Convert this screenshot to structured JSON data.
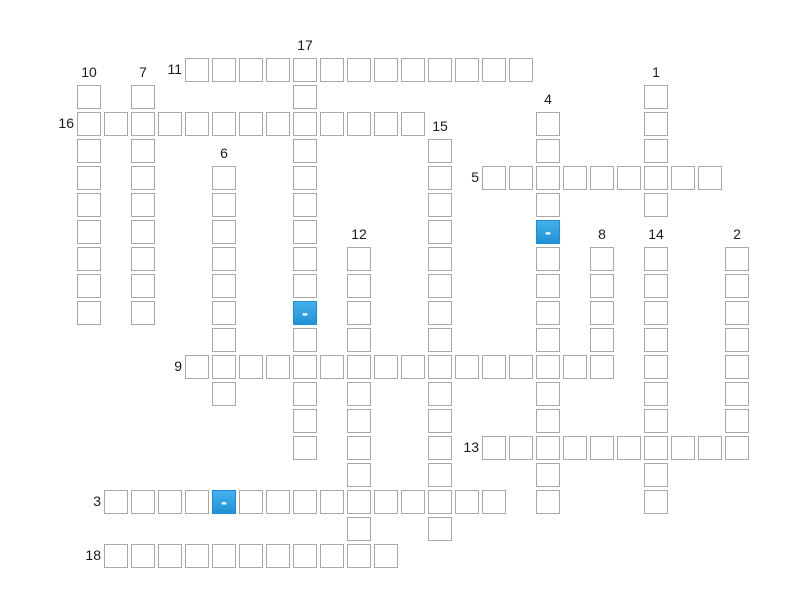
{
  "puzzle": {
    "type": "crossword-grid",
    "background_color": "#ffffff",
    "cell": {
      "size": 24,
      "pitch": 27,
      "origin_x": 77,
      "origin_y": 58,
      "fill": "#ffffff",
      "border_color": "#a8a8a8"
    },
    "highlight": {
      "fill_top": "#45b0ea",
      "fill_bottom": "#1f93d7",
      "border_color": "#1a8fd1",
      "dash_color": "#ffffff"
    },
    "label_color": "#1a1a1a",
    "words": [
      {
        "number": "17",
        "direction": "down",
        "col": 8,
        "row": 0,
        "length": 15
      },
      {
        "number": "11",
        "direction": "across",
        "col": 4,
        "row": 0,
        "length": 13
      },
      {
        "number": "10",
        "direction": "down",
        "col": 0,
        "row": 1,
        "length": 9
      },
      {
        "number": "7",
        "direction": "down",
        "col": 2,
        "row": 1,
        "length": 9
      },
      {
        "number": "1",
        "direction": "down",
        "col": 21,
        "row": 1,
        "length": 5
      },
      {
        "number": "16",
        "direction": "across",
        "col": 0,
        "row": 2,
        "length": 13
      },
      {
        "number": "4",
        "direction": "down",
        "col": 17,
        "row": 2,
        "length": 15
      },
      {
        "number": "15",
        "direction": "down",
        "col": 13,
        "row": 3,
        "length": 15
      },
      {
        "number": "6",
        "direction": "down",
        "col": 5,
        "row": 4,
        "length": 9
      },
      {
        "number": "5",
        "direction": "across",
        "col": 15,
        "row": 4,
        "length": 9
      },
      {
        "number": "12",
        "direction": "down",
        "col": 10,
        "row": 7,
        "length": 12
      },
      {
        "number": "8",
        "direction": "down",
        "col": 19,
        "row": 7,
        "length": 5
      },
      {
        "number": "14",
        "direction": "down",
        "col": 21,
        "row": 7,
        "length": 10
      },
      {
        "number": "2",
        "direction": "down",
        "col": 24,
        "row": 7,
        "length": 8
      },
      {
        "number": "9",
        "direction": "across",
        "col": 4,
        "row": 11,
        "length": 16
      },
      {
        "number": "13",
        "direction": "across",
        "col": 15,
        "row": 14,
        "length": 10
      },
      {
        "number": "3",
        "direction": "across",
        "col": 1,
        "row": 16,
        "length": 15
      },
      {
        "number": "18",
        "direction": "across",
        "col": 1,
        "row": 18,
        "length": 11
      }
    ],
    "highlighted_cells": [
      {
        "col": 17,
        "row": 6,
        "char": "-"
      },
      {
        "col": 8,
        "row": 9,
        "char": "-"
      },
      {
        "col": 5,
        "row": 16,
        "char": "-"
      }
    ]
  }
}
